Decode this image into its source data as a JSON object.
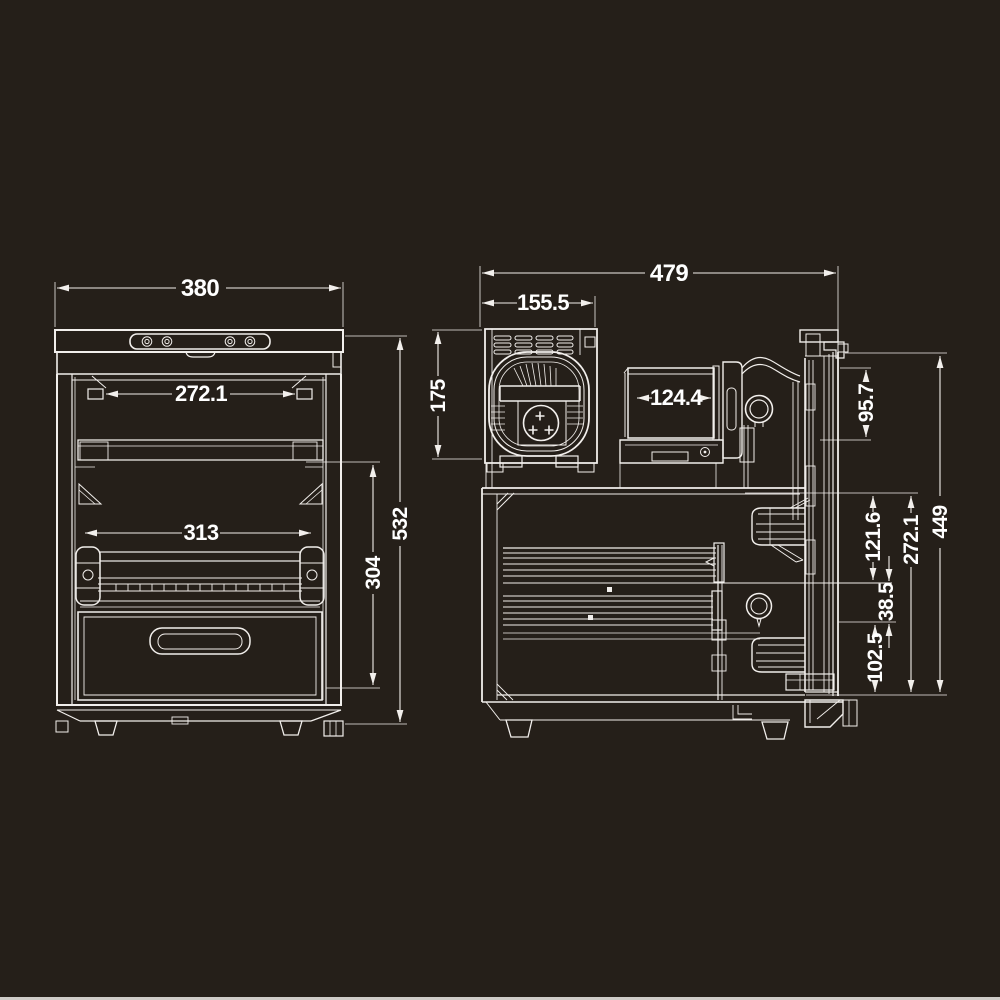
{
  "colors": {
    "background": "#251f19",
    "lines": "#f2efec",
    "text": "#ffffff",
    "bottom_border": "#cfccc8"
  },
  "drawing": {
    "type": "technical-dimension-drawing",
    "subject": "compact refrigerator / dry cabinet, front elevation and side section",
    "front": {
      "view_name": "front-elevation",
      "dims": {
        "overall_width": "380",
        "inner_width_upper": "272.1",
        "inner_width_lower": "313",
        "interior_height": "304",
        "overall_height": "532"
      }
    },
    "side": {
      "view_name": "side-section",
      "dims": {
        "overall_depth": "479",
        "machine_compartment_depth": "155.5",
        "machine_compartment_height": "175",
        "evaporator_box_depth": "124.4",
        "top_section_height": "95.7",
        "upper_shelf_span": "121.6",
        "interior_height": "272.1",
        "shelf_gap": "38.5",
        "bottom_section_height": "102.5",
        "body_side_height": "449"
      }
    }
  }
}
